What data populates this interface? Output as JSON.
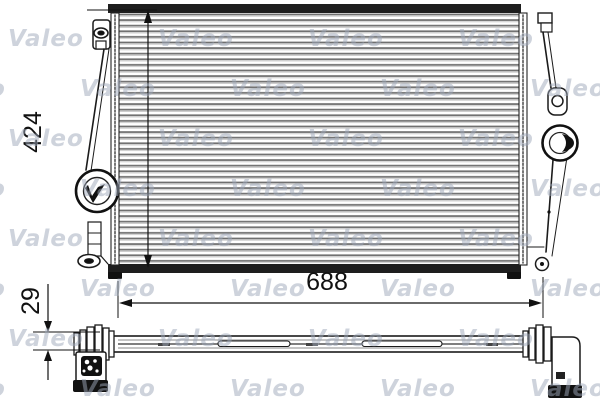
{
  "page": {
    "background": "#ffffff",
    "line_color": "#1b1b1b"
  },
  "watermark": {
    "text": "Valeo",
    "color": "rgba(158,167,186,0.5)",
    "rows": 8,
    "cols": 5,
    "row_spacing": 50,
    "col_spacing": 150,
    "odd_row_offset": -70,
    "font_size": 23
  },
  "dimensions": {
    "height": "424",
    "width": "688",
    "depth": "29"
  }
}
